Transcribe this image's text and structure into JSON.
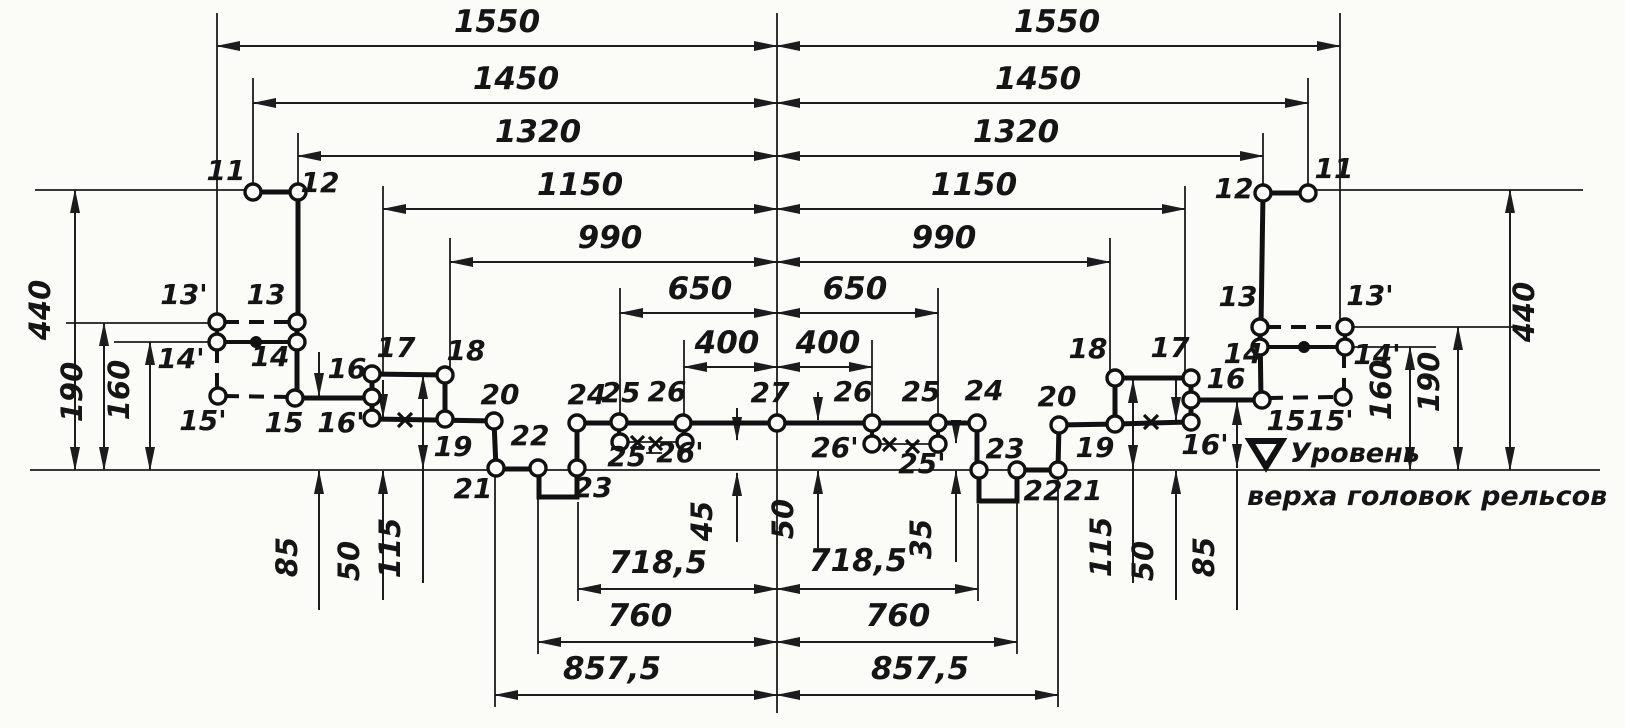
{
  "figure": {
    "type": "engineering-clearance-diagram",
    "language": "ru",
    "baseline": {
      "symbol": "rail-level-mark",
      "line1": "Уровень",
      "line2": "верха головок рельсов"
    },
    "horizontal_dimensions_mm": [
      1550,
      1450,
      1320,
      1150,
      990,
      650,
      400
    ],
    "bottom_dimensions_mm": [
      "857,5",
      "760",
      "718,5"
    ],
    "vertical_dimensions_left_mm": [
      440,
      190,
      160,
      85,
      50,
      115
    ],
    "vertical_dimensions_center_mm": [
      45,
      50,
      35
    ],
    "vertical_dimensions_right_mm": [
      115,
      50,
      85,
      160,
      190,
      440
    ],
    "profile_points": [
      "11",
      "12",
      "13",
      "13'",
      "14",
      "14'",
      "15",
      "15'",
      "16",
      "16'",
      "17",
      "18",
      "19",
      "20",
      "21",
      "22",
      "23",
      "24",
      "25",
      "25'",
      "26",
      "26'",
      "27"
    ],
    "symmetry": "mirrored-about-center-axis"
  },
  "labels": {
    "d1550": "1550",
    "d1450": "1450",
    "d1320": "1320",
    "d1150": "1150",
    "d990": "990",
    "d650": "650",
    "d400": "400",
    "d440": "440",
    "d190": "190",
    "d160": "160",
    "d85": "85",
    "d50": "50",
    "d115": "115",
    "d45": "45",
    "d35": "35",
    "d718": "718,5",
    "d760": "760",
    "d857": "857,5",
    "p11": "11",
    "p12": "12",
    "p13": "13",
    "p13p": "13'",
    "p14": "14",
    "p14p": "14'",
    "p15": "15",
    "p15p": "15'",
    "p16": "16",
    "p16p": "16'",
    "p17": "17",
    "p18": "18",
    "p19": "19",
    "p20": "20",
    "p21": "21",
    "p22": "22",
    "p23": "23",
    "p24": "24",
    "p25": "25",
    "p25p": "25'",
    "p26": "26",
    "p26p": "26'",
    "p27": "27",
    "level1": "Уровень",
    "level2": "верха головок рельсов"
  }
}
